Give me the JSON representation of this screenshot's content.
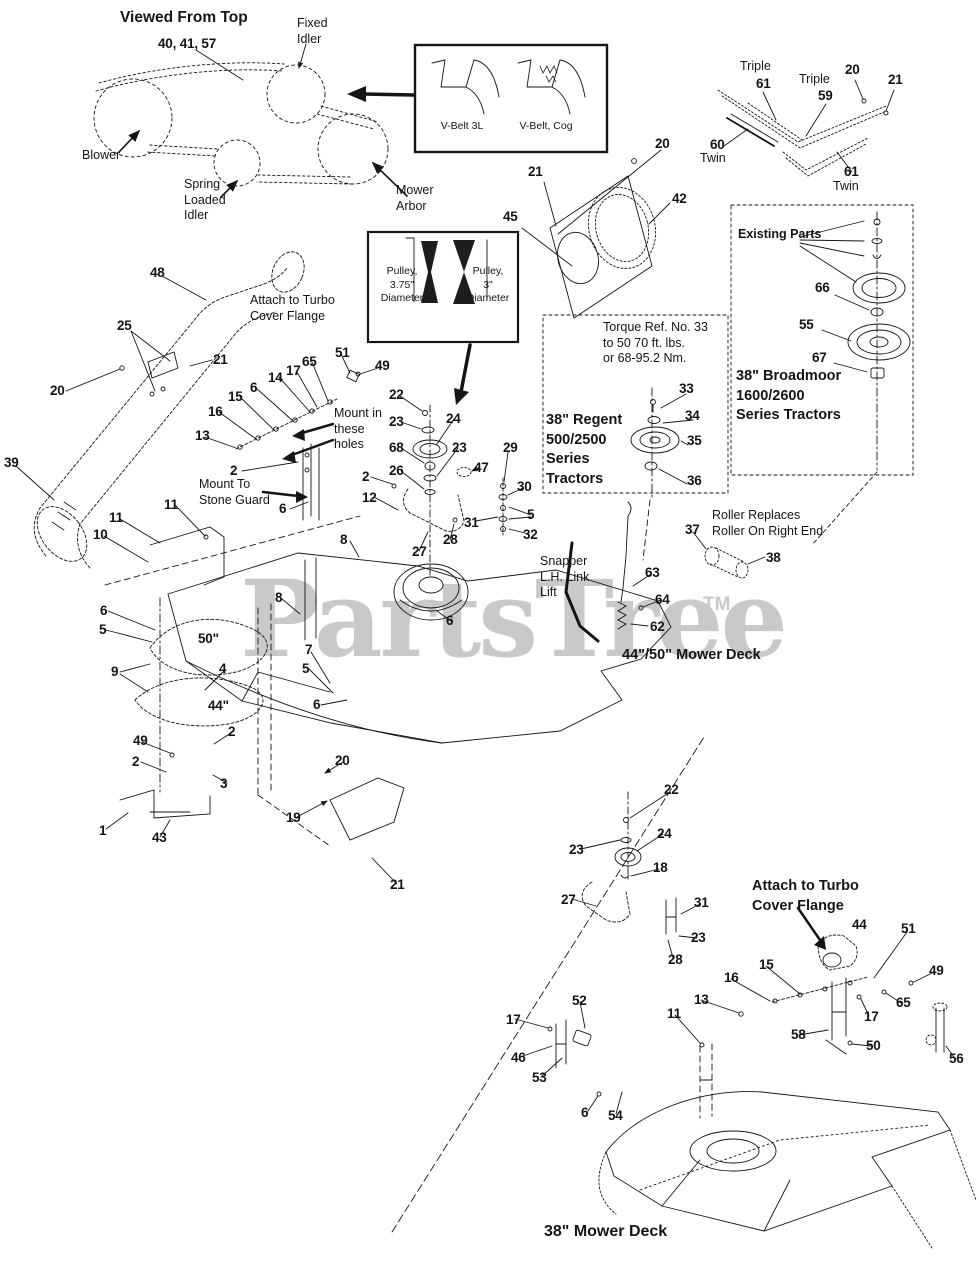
{
  "watermark": {
    "text": "PartsTree",
    "tm": "TM",
    "color": "#c9c9c9"
  },
  "labels": [
    {
      "t": "Viewed From Top",
      "x": 120,
      "y": 8,
      "c": "v"
    },
    {
      "t": "40, 41, 57",
      "x": 158,
      "y": 36,
      "c": "n"
    },
    {
      "t": "Fixed\nIdler",
      "x": 297,
      "y": 16,
      "c": "t"
    },
    {
      "t": "Blower",
      "x": 82,
      "y": 148,
      "c": "t"
    },
    {
      "t": "Spring\nLoaded\nIdler",
      "x": 184,
      "y": 177,
      "c": "t"
    },
    {
      "t": "Mower\nArbor",
      "x": 396,
      "y": 183,
      "c": "t"
    },
    {
      "t": "V-Belt 3L",
      "x": 432,
      "y": 120,
      "c": "s"
    },
    {
      "t": "V-Belt, Cog",
      "x": 516,
      "y": 120,
      "c": "s"
    },
    {
      "t": "Triple",
      "x": 740,
      "y": 59,
      "c": "t"
    },
    {
      "t": "61",
      "x": 756,
      "y": 76,
      "c": "n"
    },
    {
      "t": "Triple",
      "x": 799,
      "y": 72,
      "c": "t"
    },
    {
      "t": "59",
      "x": 818,
      "y": 88,
      "c": "n"
    },
    {
      "t": "20",
      "x": 845,
      "y": 62,
      "c": "n"
    },
    {
      "t": "21",
      "x": 888,
      "y": 72,
      "c": "n"
    },
    {
      "t": "60",
      "x": 710,
      "y": 137,
      "c": "n"
    },
    {
      "t": "Twin",
      "x": 700,
      "y": 151,
      "c": "t"
    },
    {
      "t": "61",
      "x": 844,
      "y": 164,
      "c": "n"
    },
    {
      "t": "Twin",
      "x": 833,
      "y": 179,
      "c": "t"
    },
    {
      "t": "20",
      "x": 655,
      "y": 136,
      "c": "n"
    },
    {
      "t": "21",
      "x": 528,
      "y": 164,
      "c": "n"
    },
    {
      "t": "45",
      "x": 503,
      "y": 209,
      "c": "n"
    },
    {
      "t": "42",
      "x": 672,
      "y": 191,
      "c": "n"
    },
    {
      "t": "Existing Parts",
      "x": 738,
      "y": 227,
      "c": "b"
    },
    {
      "t": "66",
      "x": 815,
      "y": 280,
      "c": "n"
    },
    {
      "t": "55",
      "x": 799,
      "y": 317,
      "c": "n"
    },
    {
      "t": "67",
      "x": 812,
      "y": 350,
      "c": "n"
    },
    {
      "t": "38\" Broadmoor\n1600/2600\nSeries Tractors",
      "x": 736,
      "y": 367,
      "c": "h"
    },
    {
      "t": "Torque Ref. No. 33\nto 50 70 ft. lbs.\nor 68-95.2 Nm.",
      "x": 603,
      "y": 320,
      "c": "t"
    },
    {
      "t": "33",
      "x": 679,
      "y": 381,
      "c": "n"
    },
    {
      "t": "34",
      "x": 685,
      "y": 408,
      "c": "n"
    },
    {
      "t": "35",
      "x": 687,
      "y": 433,
      "c": "n"
    },
    {
      "t": "36",
      "x": 687,
      "y": 473,
      "c": "n"
    },
    {
      "t": "38\" Regent\n500/2500\nSeries\nTractors",
      "x": 546,
      "y": 411,
      "c": "h"
    },
    {
      "t": "Pulley,\n3.75\"\nDiameter",
      "x": 372,
      "y": 265,
      "c": "s"
    },
    {
      "t": "Pulley,\n3\"\nDiameter",
      "x": 458,
      "y": 265,
      "c": "s"
    },
    {
      "t": "48",
      "x": 150,
      "y": 265,
      "c": "n"
    },
    {
      "t": "Attach to Turbo\nCover Flange",
      "x": 250,
      "y": 293,
      "c": "t"
    },
    {
      "t": "25",
      "x": 117,
      "y": 318,
      "c": "n"
    },
    {
      "t": "21",
      "x": 213,
      "y": 352,
      "c": "n"
    },
    {
      "t": "20",
      "x": 50,
      "y": 383,
      "c": "n"
    },
    {
      "t": "39",
      "x": 4,
      "y": 455,
      "c": "n"
    },
    {
      "t": "65",
      "x": 302,
      "y": 354,
      "c": "n"
    },
    {
      "t": "17",
      "x": 286,
      "y": 363,
      "c": "n"
    },
    {
      "t": "14",
      "x": 268,
      "y": 370,
      "c": "n"
    },
    {
      "t": "6",
      "x": 250,
      "y": 380,
      "c": "n"
    },
    {
      "t": "15",
      "x": 228,
      "y": 389,
      "c": "n"
    },
    {
      "t": "16",
      "x": 208,
      "y": 404,
      "c": "n"
    },
    {
      "t": "13",
      "x": 195,
      "y": 428,
      "c": "n"
    },
    {
      "t": "2",
      "x": 230,
      "y": 463,
      "c": "n"
    },
    {
      "t": "Mount To\nStone Guard",
      "x": 199,
      "y": 477,
      "c": "t"
    },
    {
      "t": "6",
      "x": 279,
      "y": 501,
      "c": "n"
    },
    {
      "t": "11",
      "x": 164,
      "y": 497,
      "c": "n"
    },
    {
      "t": "11",
      "x": 109,
      "y": 510,
      "c": "n"
    },
    {
      "t": "10",
      "x": 93,
      "y": 527,
      "c": "n"
    },
    {
      "t": "51",
      "x": 335,
      "y": 345,
      "c": "n"
    },
    {
      "t": "49",
      "x": 375,
      "y": 358,
      "c": "n"
    },
    {
      "t": "Mount in\nthese\nholes",
      "x": 334,
      "y": 406,
      "c": "t"
    },
    {
      "t": "22",
      "x": 389,
      "y": 387,
      "c": "n"
    },
    {
      "t": "23",
      "x": 389,
      "y": 414,
      "c": "n"
    },
    {
      "t": "24",
      "x": 446,
      "y": 411,
      "c": "n"
    },
    {
      "t": "68",
      "x": 389,
      "y": 440,
      "c": "n"
    },
    {
      "t": "23",
      "x": 452,
      "y": 440,
      "c": "n"
    },
    {
      "t": "26",
      "x": 389,
      "y": 463,
      "c": "n"
    },
    {
      "t": "47",
      "x": 474,
      "y": 460,
      "c": "n"
    },
    {
      "t": "29",
      "x": 503,
      "y": 440,
      "c": "n"
    },
    {
      "t": "30",
      "x": 517,
      "y": 479,
      "c": "n"
    },
    {
      "t": "5",
      "x": 527,
      "y": 507,
      "c": "n"
    },
    {
      "t": "31",
      "x": 464,
      "y": 515,
      "c": "n"
    },
    {
      "t": "32",
      "x": 523,
      "y": 527,
      "c": "n"
    },
    {
      "t": "2",
      "x": 362,
      "y": 469,
      "c": "n"
    },
    {
      "t": "12",
      "x": 362,
      "y": 490,
      "c": "n"
    },
    {
      "t": "8",
      "x": 340,
      "y": 532,
      "c": "n"
    },
    {
      "t": "27",
      "x": 412,
      "y": 544,
      "c": "n"
    },
    {
      "t": "28",
      "x": 443,
      "y": 532,
      "c": "n"
    },
    {
      "t": "Snapper\nL.H. Link\nLift",
      "x": 540,
      "y": 554,
      "c": "t"
    },
    {
      "t": "63",
      "x": 645,
      "y": 565,
      "c": "n"
    },
    {
      "t": "64",
      "x": 655,
      "y": 592,
      "c": "n"
    },
    {
      "t": "62",
      "x": 650,
      "y": 619,
      "c": "n"
    },
    {
      "t": "37",
      "x": 685,
      "y": 522,
      "c": "n"
    },
    {
      "t": "Roller Replaces\nRoller On Right End",
      "x": 712,
      "y": 508,
      "c": "t"
    },
    {
      "t": "38",
      "x": 766,
      "y": 550,
      "c": "n"
    },
    {
      "t": "44\"/50\" Mower Deck",
      "x": 622,
      "y": 646,
      "c": "h"
    },
    {
      "t": "6",
      "x": 100,
      "y": 603,
      "c": "n"
    },
    {
      "t": "5",
      "x": 99,
      "y": 622,
      "c": "n"
    },
    {
      "t": "9",
      "x": 111,
      "y": 664,
      "c": "n"
    },
    {
      "t": "50\"",
      "x": 198,
      "y": 631,
      "c": "n"
    },
    {
      "t": "4",
      "x": 219,
      "y": 661,
      "c": "n"
    },
    {
      "t": "44\"",
      "x": 208,
      "y": 698,
      "c": "n"
    },
    {
      "t": "49",
      "x": 133,
      "y": 733,
      "c": "n"
    },
    {
      "t": "2",
      "x": 132,
      "y": 754,
      "c": "n"
    },
    {
      "t": "2",
      "x": 228,
      "y": 724,
      "c": "n"
    },
    {
      "t": "3",
      "x": 220,
      "y": 776,
      "c": "n"
    },
    {
      "t": "1",
      "x": 99,
      "y": 823,
      "c": "n"
    },
    {
      "t": "43",
      "x": 152,
      "y": 830,
      "c": "n"
    },
    {
      "t": "19",
      "x": 286,
      "y": 810,
      "c": "n"
    },
    {
      "t": "20",
      "x": 335,
      "y": 753,
      "c": "n"
    },
    {
      "t": "21",
      "x": 390,
      "y": 877,
      "c": "n"
    },
    {
      "t": "8",
      "x": 275,
      "y": 590,
      "c": "n"
    },
    {
      "t": "7",
      "x": 305,
      "y": 642,
      "c": "n"
    },
    {
      "t": "5",
      "x": 302,
      "y": 661,
      "c": "n"
    },
    {
      "t": "6",
      "x": 313,
      "y": 697,
      "c": "n"
    },
    {
      "t": "6",
      "x": 446,
      "y": 613,
      "c": "n"
    },
    {
      "t": "22",
      "x": 664,
      "y": 782,
      "c": "n"
    },
    {
      "t": "23",
      "x": 569,
      "y": 842,
      "c": "n"
    },
    {
      "t": "24",
      "x": 657,
      "y": 826,
      "c": "n"
    },
    {
      "t": "18",
      "x": 653,
      "y": 860,
      "c": "n"
    },
    {
      "t": "27",
      "x": 561,
      "y": 892,
      "c": "n"
    },
    {
      "t": "31",
      "x": 694,
      "y": 895,
      "c": "n"
    },
    {
      "t": "23",
      "x": 691,
      "y": 930,
      "c": "n"
    },
    {
      "t": "28",
      "x": 668,
      "y": 952,
      "c": "n"
    },
    {
      "t": "Attach to Turbo\nCover Flange",
      "x": 752,
      "y": 877,
      "c": "h"
    },
    {
      "t": "44",
      "x": 852,
      "y": 917,
      "c": "n"
    },
    {
      "t": "51",
      "x": 901,
      "y": 921,
      "c": "n"
    },
    {
      "t": "49",
      "x": 929,
      "y": 963,
      "c": "n"
    },
    {
      "t": "65",
      "x": 896,
      "y": 995,
      "c": "n"
    },
    {
      "t": "15",
      "x": 759,
      "y": 957,
      "c": "n"
    },
    {
      "t": "16",
      "x": 724,
      "y": 970,
      "c": "n"
    },
    {
      "t": "13",
      "x": 694,
      "y": 992,
      "c": "n"
    },
    {
      "t": "11",
      "x": 667,
      "y": 1006,
      "c": "n"
    },
    {
      "t": "17",
      "x": 864,
      "y": 1009,
      "c": "n"
    },
    {
      "t": "58",
      "x": 791,
      "y": 1027,
      "c": "n"
    },
    {
      "t": "50",
      "x": 866,
      "y": 1038,
      "c": "n"
    },
    {
      "t": "56",
      "x": 949,
      "y": 1051,
      "c": "n"
    },
    {
      "t": "17",
      "x": 506,
      "y": 1012,
      "c": "n"
    },
    {
      "t": "46",
      "x": 511,
      "y": 1050,
      "c": "n"
    },
    {
      "t": "53",
      "x": 532,
      "y": 1070,
      "c": "n"
    },
    {
      "t": "52",
      "x": 572,
      "y": 993,
      "c": "n"
    },
    {
      "t": "6",
      "x": 581,
      "y": 1105,
      "c": "n"
    },
    {
      "t": "54",
      "x": 608,
      "y": 1108,
      "c": "n"
    },
    {
      "t": "38\" Mower Deck",
      "x": 544,
      "y": 1222,
      "c": "H"
    }
  ]
}
